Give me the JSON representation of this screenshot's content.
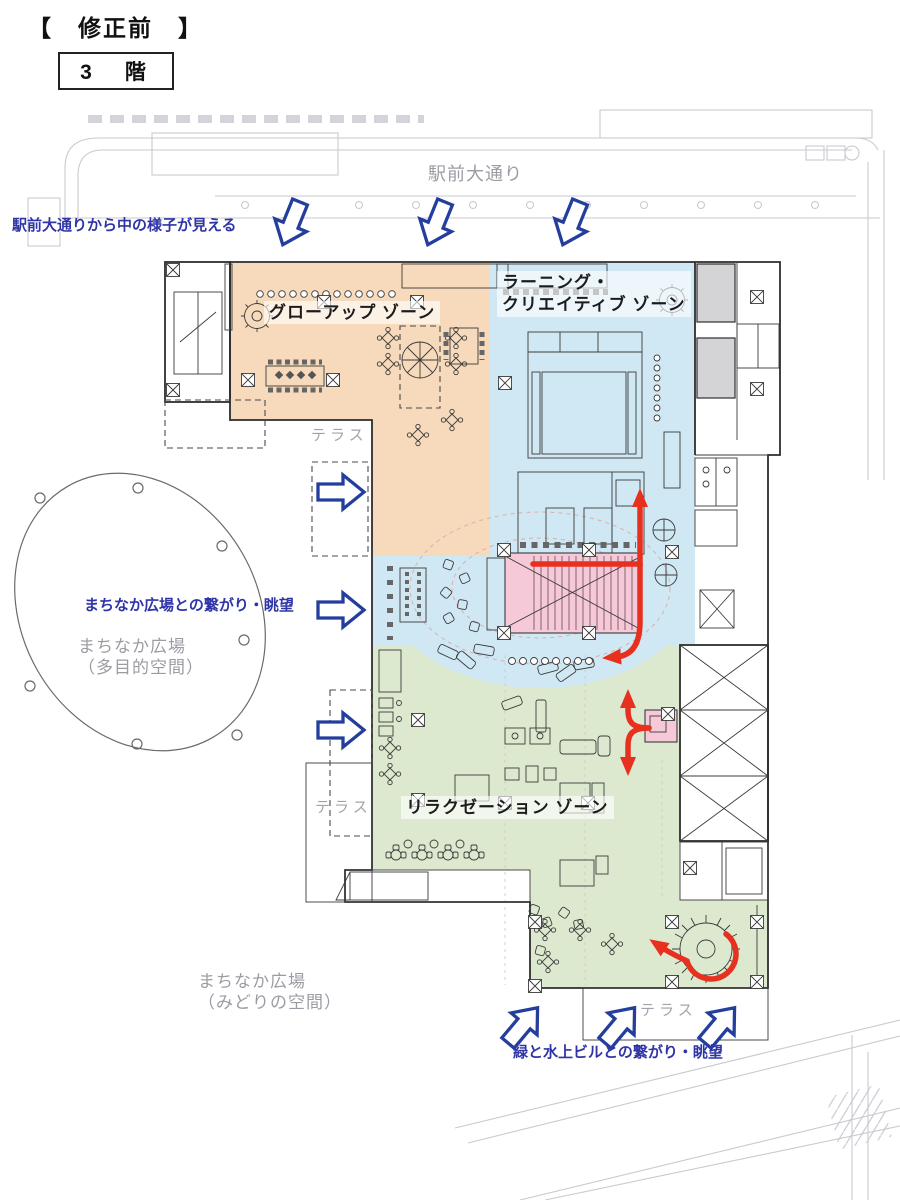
{
  "header": {
    "revision": "【　修正前　】",
    "floor": "3　階"
  },
  "street": {
    "name": "駅前大通り"
  },
  "annotations": {
    "street_view": "駅前大通りから中の様子が見える",
    "plaza_link": "まちなか広場との繋がり・眺望",
    "green_link": "緑と水上ビルとの繋がり・眺望"
  },
  "zones": {
    "growup": "グローアップ ゾーン",
    "learning_line1": "ラーニング・",
    "learning_line2": "クリエイティブ ゾーン",
    "relaxation": "リラクゼーション ゾーン"
  },
  "plaza_multi": {
    "line1": "まちなか広場",
    "line2": "（多目的空間）"
  },
  "plaza_green": {
    "line1": "まちなか広場",
    "line2": "（みどりの空間）"
  },
  "terrace": "テラス",
  "colors": {
    "accent-blue": "#243e9e",
    "annotation-blue": "#2f35a6",
    "red": "#e8301f",
    "zone-orange": "#f7dabb",
    "zone-blue": "#cfe8f3",
    "zone-green": "#dde9cf",
    "pink": "#f6c9d9",
    "gray-room": "#d4d4d6",
    "street": "#c9cad1",
    "gray-text": "#9b9ca3"
  }
}
